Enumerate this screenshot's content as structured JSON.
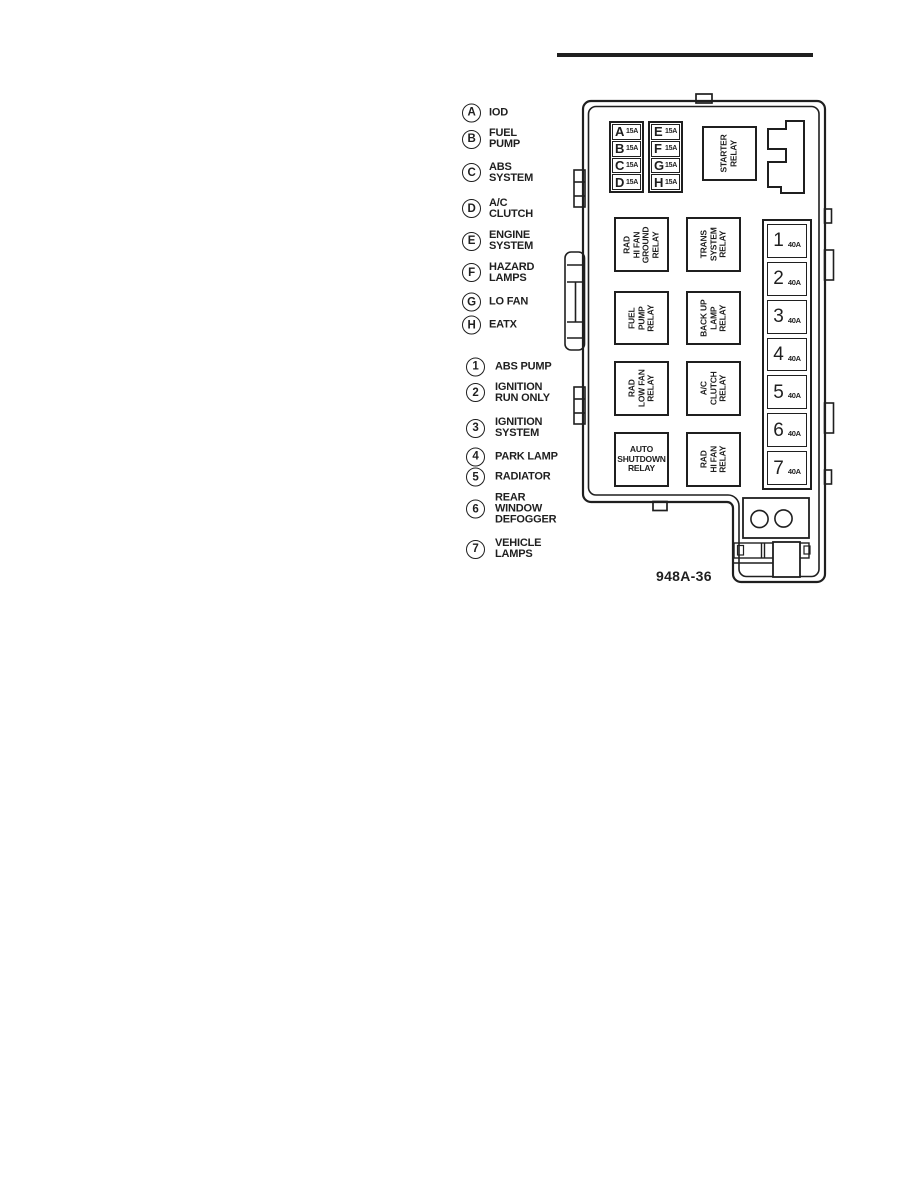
{
  "figure": {
    "code": "948A-36"
  },
  "legend": {
    "letter_items": [
      {
        "symbol": "A",
        "label": "IOD"
      },
      {
        "symbol": "B",
        "label": "FUEL\nPUMP"
      },
      {
        "symbol": "C",
        "label": "ABS\nSYSTEM"
      },
      {
        "symbol": "D",
        "label": "A/C\nCLUTCH"
      },
      {
        "symbol": "E",
        "label": "ENGINE\nSYSTEM"
      },
      {
        "symbol": "F",
        "label": "HAZARD\nLAMPS"
      },
      {
        "symbol": "G",
        "label": "LO FAN"
      },
      {
        "symbol": "H",
        "label": "EATX"
      }
    ],
    "number_items": [
      {
        "symbol": "1",
        "label": "ABS PUMP"
      },
      {
        "symbol": "2",
        "label": "IGNITION\nRUN ONLY"
      },
      {
        "symbol": "3",
        "label": "IGNITION\nSYSTEM"
      },
      {
        "symbol": "4",
        "label": "PARK LAMP"
      },
      {
        "symbol": "5",
        "label": "RADIATOR"
      },
      {
        "symbol": "6",
        "label": "REAR\nWINDOW\nDEFOGGER"
      },
      {
        "symbol": "7",
        "label": "VEHICLE\nLAMPS"
      }
    ]
  },
  "pdc": {
    "letter_fuses": [
      {
        "letter": "A",
        "amps": "15A"
      },
      {
        "letter": "B",
        "amps": "15A"
      },
      {
        "letter": "C",
        "amps": "15A"
      },
      {
        "letter": "D",
        "amps": "15A"
      },
      {
        "letter": "E",
        "amps": "15A"
      },
      {
        "letter": "F",
        "amps": "15A"
      },
      {
        "letter": "G",
        "amps": "15A"
      },
      {
        "letter": "H",
        "amps": "15A"
      }
    ],
    "relays": {
      "starter": "STARTER\nRELAY",
      "rad_hi_fan_ground": "RAD\nHI FAN\nGROUND\nRELAY",
      "trans_system": "TRANS\nSYSTEM\nRELAY",
      "fuel_pump": "FUEL\nPUMP\nRELAY",
      "back_up_lamp": "BACK UP\nLAMP\nRELAY",
      "rad_low_fan": "RAD\nLOW FAN\nRELAY",
      "ac_clutch": "A/C\nCLUTCH\nRELAY",
      "auto_shutdown": "AUTO\nSHUTDOWN\nRELAY",
      "rad_hi_fan": "RAD\nHI FAN\nRELAY"
    },
    "maxi_fuses": [
      {
        "number": "1",
        "amps": "40A"
      },
      {
        "number": "2",
        "amps": "40A"
      },
      {
        "number": "3",
        "amps": "40A"
      },
      {
        "number": "4",
        "amps": "40A"
      },
      {
        "number": "5",
        "amps": "40A"
      },
      {
        "number": "6",
        "amps": "40A"
      },
      {
        "number": "7",
        "amps": "40A"
      }
    ]
  }
}
